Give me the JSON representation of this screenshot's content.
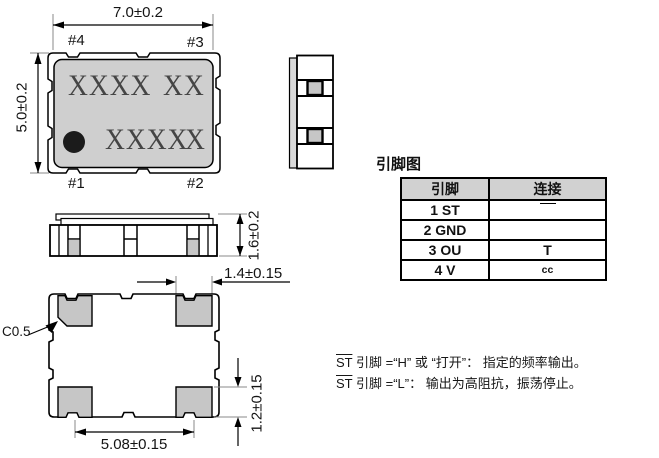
{
  "colors": {
    "body_gray": "#cfcfcf",
    "pad_gray": "#c6c6c6",
    "lid_gray": "#d9d9d9",
    "table_header_gray": "#d1d1d1",
    "line_black": "#000000"
  },
  "top_view": {
    "dim_width": "7.0±0.2",
    "dim_height": "5.0±0.2",
    "pin1": "#1",
    "pin2": "#2",
    "pin3": "#3",
    "pin4": "#4",
    "marking_line1_left": "XXXX",
    "marking_line1_right": "XX",
    "marking_line2_left": "XXXX",
    "marking_line2_right": "X"
  },
  "front_view": {
    "dim_height": "1.6±0.2"
  },
  "bottom_view": {
    "dim_pad_width": "1.4±0.15",
    "dim_pad_height": "1.2±0.15",
    "dim_pad_pitch": "5.08±0.15",
    "chamfer_label": "C0.5"
  },
  "pin_table": {
    "title": "引脚图",
    "col_pin": "引脚",
    "col_connect": "连接",
    "rows": [
      {
        "pin": "1 ST",
        "connect": ""
      },
      {
        "pin": "2 GND",
        "connect": ""
      },
      {
        "pin": "3 OU",
        "connect": "T"
      },
      {
        "pin": "4 V",
        "connect": "cc"
      }
    ]
  },
  "notes": [
    {
      "st": "ST",
      "text": " 引脚 =“H” 或 “打开”：  指定的频率输出。"
    },
    {
      "st": "ST",
      "text": " 引脚 =“L”：  输出为高阻抗，振荡停止。"
    }
  ]
}
